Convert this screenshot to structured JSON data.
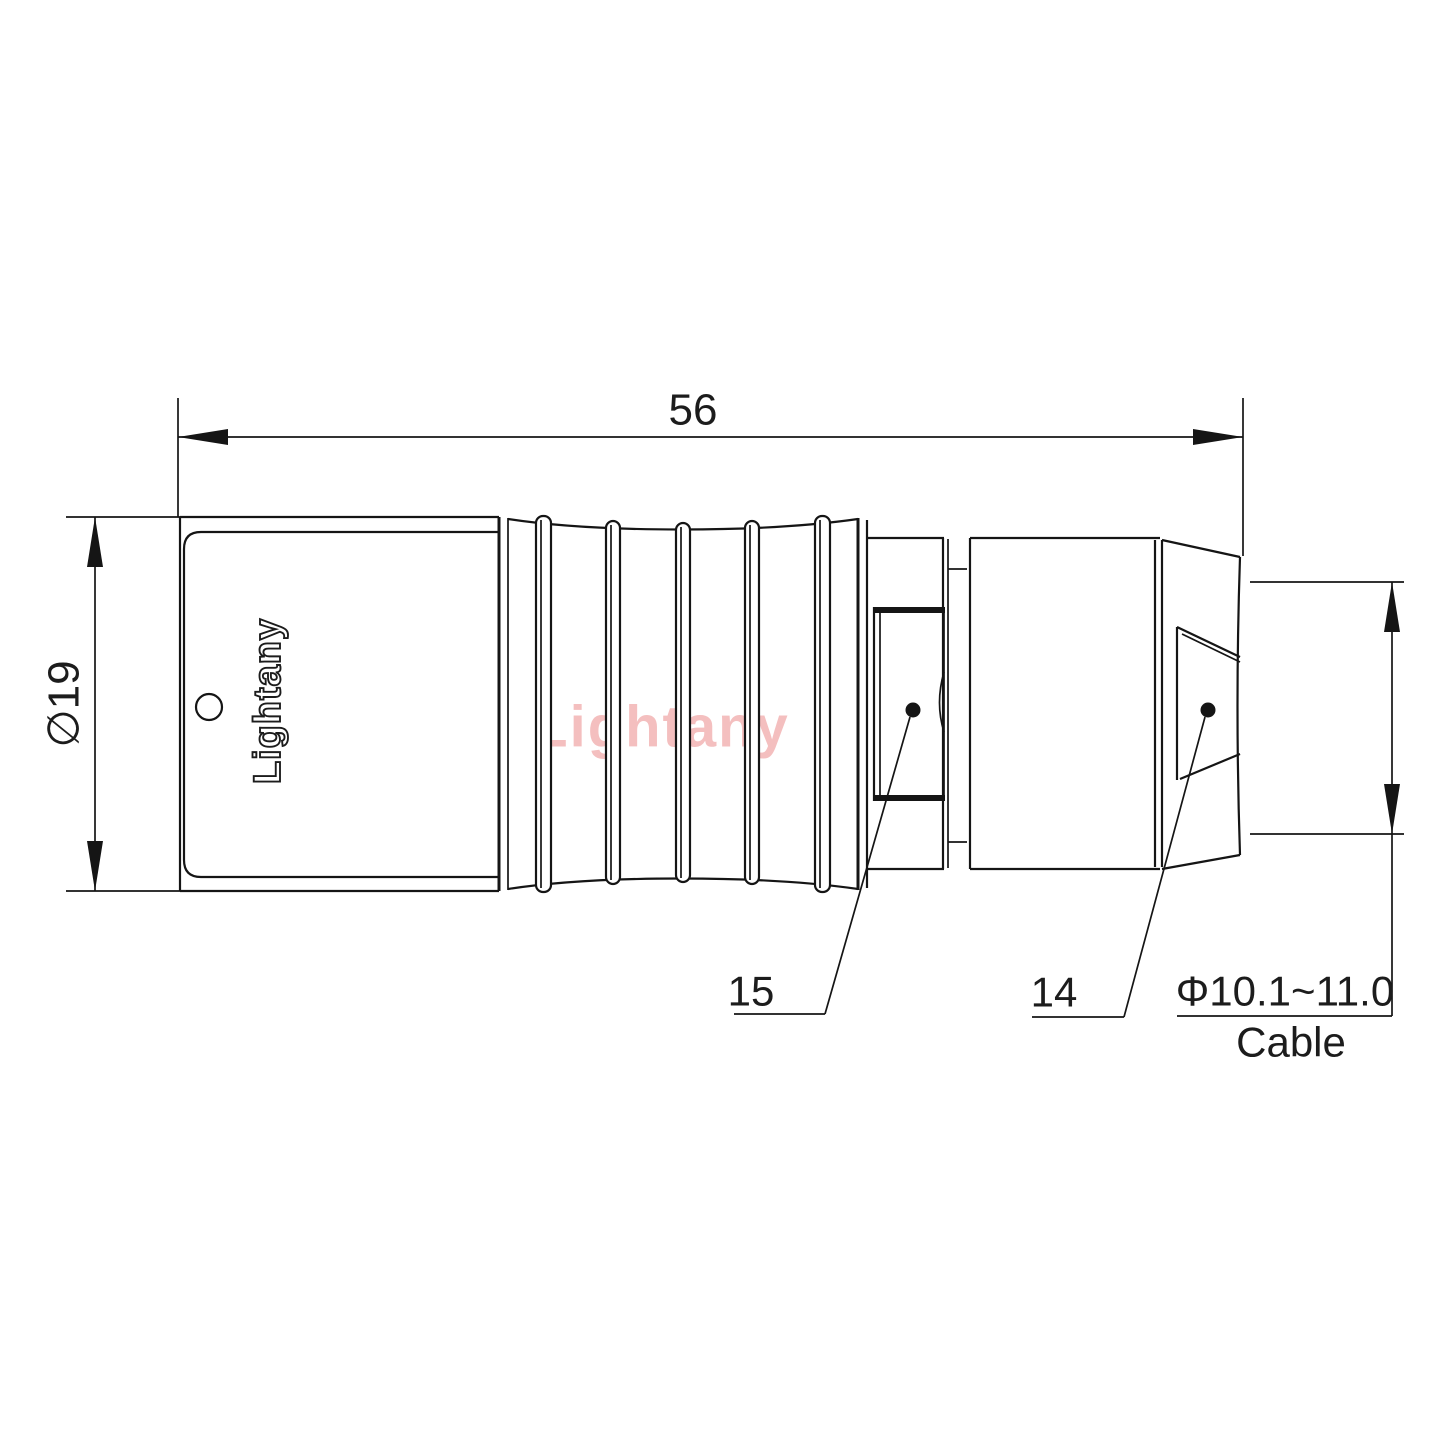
{
  "page": {
    "background": "#ffffff"
  },
  "colors": {
    "line": "#151515",
    "text": "#1c1c1c",
    "watermark_pink": "#f4bfbf"
  },
  "dimensions": {
    "overall_length": "56",
    "body_diameter": "∅19",
    "cable_diameter_range": "Φ10.1~11.0",
    "cable_caption": "Cable"
  },
  "part_labels": {
    "strain_relief_boot": "15",
    "cable_collet_nut": "14"
  },
  "branding": {
    "body_logo": "Lightany",
    "watermark": "Lightany"
  }
}
